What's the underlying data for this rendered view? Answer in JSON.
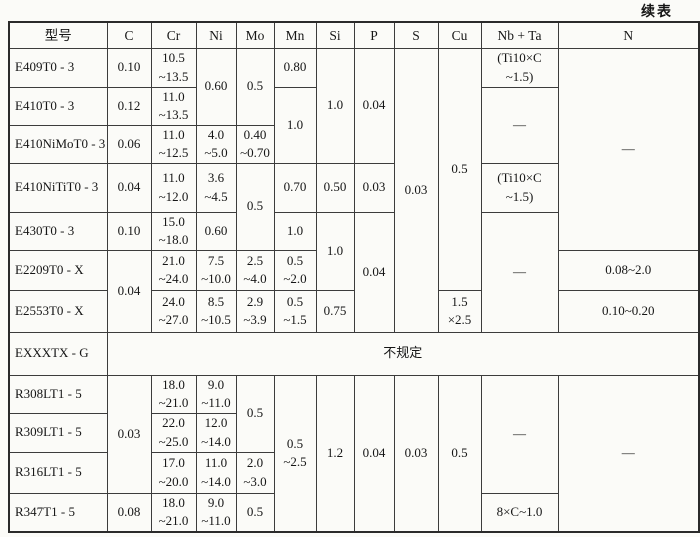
{
  "page": {
    "continued_label": "续表"
  },
  "table": {
    "headers": {
      "model": "型号",
      "c": "C",
      "cr": "Cr",
      "ni": "Ni",
      "mo": "Mo",
      "mn": "Mn",
      "si": "Si",
      "p": "P",
      "s": "S",
      "cu": "Cu",
      "nb_ta": "Nb + Ta",
      "n": "N"
    },
    "rows": {
      "e409": {
        "model": "E409T0 - 3",
        "c": "0.10",
        "cr": "10.5\n~13.5",
        "ni": "0.60",
        "mo": "0.5",
        "mn": "0.80",
        "si": "1.0",
        "p": "0.04",
        "s": "0.03",
        "cu": "0.5",
        "nb_ta": "(Ti10×C\n~1.5)",
        "n": "—"
      },
      "e410": {
        "model": "E410T0 - 3",
        "c": "0.12",
        "cr": "11.0\n~13.5",
        "mn": "1.0",
        "nb_ta": "—"
      },
      "e410nimo": {
        "model": "E410NiMoT0 - 3",
        "c": "0.06",
        "cr": "11.0\n~12.5",
        "ni": "4.0\n~5.0",
        "mo": "0.40\n~0.70"
      },
      "e410niti": {
        "model": "E410NiTiT0 - 3",
        "c": "0.04",
        "cr": "11.0\n~12.0",
        "ni": "3.6\n~4.5",
        "mo": "0.5",
        "mn": "0.70",
        "si": "0.50",
        "p": "0.03",
        "nb_ta": "(Ti10×C\n~1.5)"
      },
      "e430": {
        "model": "E430T0 - 3",
        "c": "0.10",
        "cr": "15.0\n~18.0",
        "ni": "0.60",
        "mn": "1.0",
        "si": "1.0",
        "p": "0.04",
        "nb_ta": "—"
      },
      "e2209": {
        "model": "E2209T0 - X",
        "c": "0.04",
        "cr": "21.0\n~24.0",
        "ni": "7.5\n~10.0",
        "mo": "2.5\n~4.0",
        "mn": "0.5\n~2.0",
        "n": "0.08~2.0"
      },
      "e2553": {
        "model": "E2553T0 - X",
        "cr": "24.0\n~27.0",
        "ni": "8.5\n~10.5",
        "mo": "2.9\n~3.9",
        "mn": "0.5\n~1.5",
        "si": "0.75",
        "cu": "1.5\n×2.5",
        "n": "0.10~0.20"
      },
      "exxxtx": {
        "model": "EXXXTX - G",
        "unspecified": "不规定"
      },
      "r308l": {
        "model": "R308LT1 - 5",
        "c": "0.03",
        "cr": "18.0\n~21.0",
        "ni": "9.0\n~11.0",
        "mo": "0.5",
        "mn": "0.5\n~2.5",
        "si": "1.2",
        "p": "0.04",
        "s": "0.03",
        "cu": "0.5",
        "nb_ta": "—",
        "n": "—"
      },
      "r309l": {
        "model": "R309LT1 - 5",
        "cr": "22.0\n~25.0",
        "ni": "12.0\n~14.0"
      },
      "r316l": {
        "model": "R316LT1 - 5",
        "cr": "17.0\n~20.0",
        "ni": "11.0\n~14.0",
        "mo": "2.0\n~3.0"
      },
      "r347": {
        "model": "R347T1 - 5",
        "c": "0.08",
        "cr": "18.0\n~21.0",
        "ni": "9.0\n~11.0",
        "mo": "0.5",
        "nb_ta": "8×C~1.0"
      }
    }
  }
}
